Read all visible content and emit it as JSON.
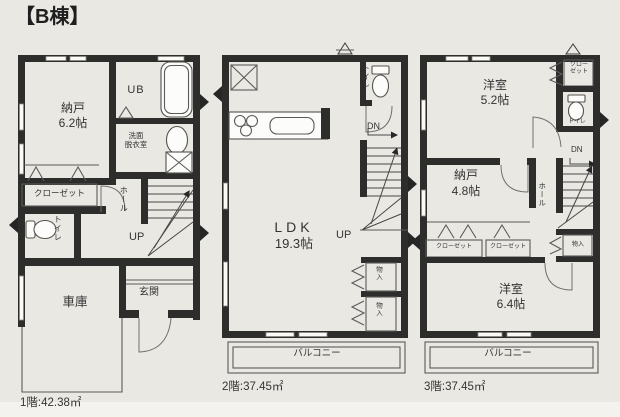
{
  "title": "【B棟】",
  "colors": {
    "wall": "#2d2d2b",
    "background": "#eae8e3",
    "paper_strip": "#f3f2ef",
    "line": "#5a5a5a",
    "text": "#343434"
  },
  "floor1": {
    "area_label": "1階:42.38㎡",
    "labels": {
      "storage_room": "納戸",
      "storage_room_size": "6.2帖",
      "unit_bath": "UB",
      "washroom": "洗面\n脱衣室",
      "closet": "クローゼット",
      "toilet": "トイレ",
      "hall": "ホール",
      "stairs_up": "UP",
      "entrance": "玄関",
      "garage": "車庫"
    }
  },
  "floor2": {
    "area_label": "2階:37.45㎡",
    "labels": {
      "ldk": "LDK",
      "ldk_size": "19.3帖",
      "toilet": "トイレ",
      "stairs_down": "DN",
      "stairs_up": "UP",
      "storage_1": "物入",
      "storage_2": "物入",
      "balcony": "バルコニー"
    }
  },
  "floor3": {
    "area_label": "3階:37.45㎡",
    "labels": {
      "bedroom_1": "洋室",
      "bedroom_1_size": "5.2帖",
      "closet_top": "クロー\nゼット",
      "toilet": "トイレ",
      "stairs_down": "DN",
      "storage_room": "納戸",
      "storage_room_size": "4.8帖",
      "hall": "ホール",
      "closet_1": "クローゼット",
      "closet_2": "クローゼット",
      "storage": "物入",
      "bedroom_2": "洋室",
      "bedroom_2_size": "6.4帖",
      "balcony": "バルコニー"
    }
  }
}
